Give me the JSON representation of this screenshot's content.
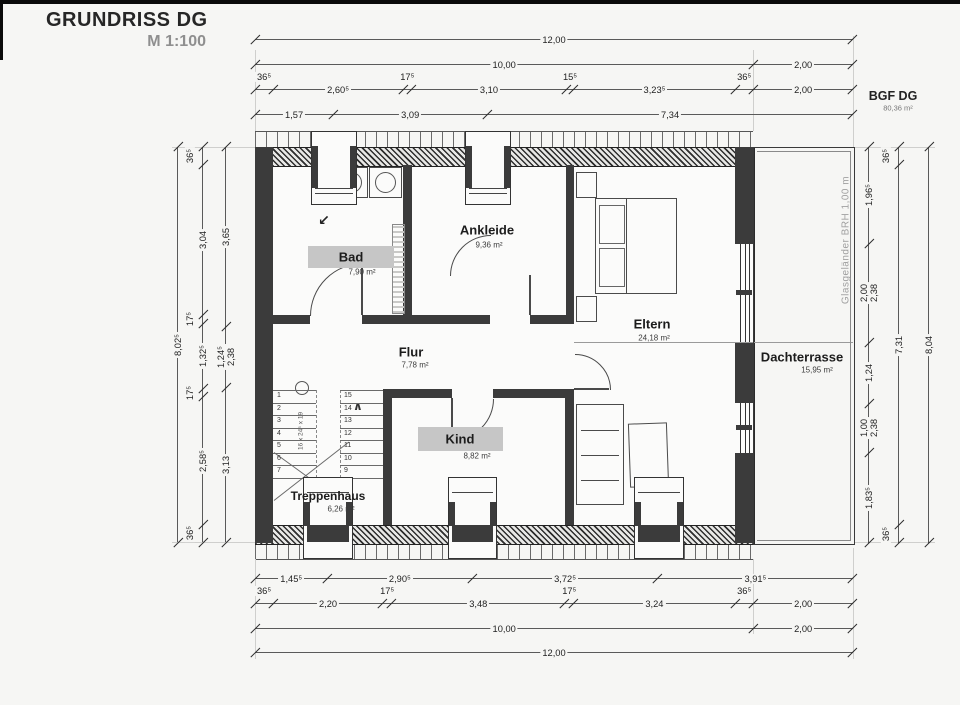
{
  "title": {
    "name": "GRUNDRISS DG",
    "scale": "M 1:100"
  },
  "summary": {
    "label": "BGF DG",
    "area": "80,36 m²"
  },
  "rooms": {
    "bad": {
      "name": "Bad",
      "area": "7,90 m²"
    },
    "ankleide": {
      "name": "Ankleide",
      "area": "9,36 m²"
    },
    "eltern": {
      "name": "Eltern",
      "area": "24,18 m²"
    },
    "flur": {
      "name": "Flur",
      "area": "7,78 m²"
    },
    "kind": {
      "name": "Kind",
      "area": "8,82 m²"
    },
    "treppenhaus": {
      "name": "Treppenhaus",
      "area": "6,26 m²"
    },
    "dachterrasse": {
      "name": "Dachterrasse",
      "area": "15,95 m²"
    }
  },
  "annotations": {
    "railing": "Glasgeländer BRH 1,00 m",
    "stair_note": "16 x 24⁵ x 19"
  },
  "icons": {
    "slope_arrow": "↙",
    "stair_direction": "∧"
  },
  "colors": {
    "highlight": "#c6c6c6",
    "wall": "#3b3b3b",
    "background": "#f6f6f4"
  },
  "stairs": {
    "left_numbers": [
      "1",
      "2",
      "3",
      "4",
      "5",
      "6",
      "7"
    ],
    "right_numbers": [
      "15",
      "14",
      "13",
      "12",
      "11",
      "10",
      "9"
    ]
  },
  "dimensions": {
    "chains": [
      {
        "o": "h",
        "x": 255,
        "y": 39,
        "ppm": 49.833,
        "segs": [
          {
            "len": 12,
            "label": "12,00"
          }
        ]
      },
      {
        "o": "h",
        "x": 255,
        "y": 64,
        "ppm": 49.833,
        "segs": [
          {
            "len": 10,
            "label": "10,00"
          },
          {
            "len": 2,
            "label": "2,00"
          }
        ]
      },
      {
        "o": "h",
        "x": 255,
        "y": 89,
        "ppm": 49.833,
        "segs": [
          {
            "len": 0.365,
            "label": "36⁵"
          },
          {
            "len": 2.605,
            "label": "2,60⁵"
          },
          {
            "len": 0.175,
            "label": "17⁵"
          },
          {
            "len": 3.1,
            "label": "3,10"
          },
          {
            "len": 0.155,
            "label": "15⁵"
          },
          {
            "len": 3.235,
            "label": "3,23⁵"
          },
          {
            "len": 0.365,
            "label": "36⁵"
          },
          {
            "len": 2,
            "label": "2,00"
          }
        ]
      },
      {
        "o": "h",
        "x": 255,
        "y": 114,
        "ppm": 49.833,
        "segs": [
          {
            "len": 1.57,
            "label": "1,57"
          },
          {
            "len": 3.09,
            "label": "3,09"
          },
          {
            "len": 7.34,
            "label": "7,34"
          }
        ]
      },
      {
        "o": "h",
        "x": 255,
        "y": 578,
        "ppm": 49.833,
        "segs": [
          {
            "len": 1.455,
            "label": "1,45⁵"
          },
          {
            "len": 2.905,
            "label": "2,90⁵"
          },
          {
            "len": 3.725,
            "label": "3,72⁵"
          },
          {
            "len": 3.915,
            "label": "3,91⁵"
          }
        ]
      },
      {
        "o": "h",
        "x": 255,
        "y": 603,
        "ppm": 49.833,
        "segs": [
          {
            "len": 0.365,
            "label": "36⁵"
          },
          {
            "len": 2.2,
            "label": "2,20"
          },
          {
            "len": 0.175,
            "label": "17⁵"
          },
          {
            "len": 3.48,
            "label": "3,48"
          },
          {
            "len": 0.175,
            "label": "17⁵"
          },
          {
            "len": 3.24,
            "label": "3,24"
          },
          {
            "len": 0.365,
            "label": "36⁵"
          },
          {
            "len": 2,
            "label": "2,00"
          }
        ]
      },
      {
        "o": "h",
        "x": 255,
        "y": 628,
        "ppm": 49.833,
        "segs": [
          {
            "len": 10,
            "label": "10,00"
          },
          {
            "len": 2,
            "label": "2,00"
          }
        ]
      },
      {
        "o": "h",
        "x": 255,
        "y": 652,
        "ppm": 49.833,
        "segs": [
          {
            "len": 12,
            "label": "12,00"
          }
        ]
      },
      {
        "o": "v",
        "x": 225,
        "y": 147,
        "ppm": 49.25,
        "segs": [
          {
            "len": 3.65,
            "label": "3,65"
          },
          {
            "len": 1.245,
            "label": "1,24⁵",
            "label2": "2,38"
          },
          {
            "len": 3.13,
            "label": "3,13"
          }
        ]
      },
      {
        "o": "v",
        "x": 202,
        "y": 147,
        "ppm": 49.25,
        "segs": [
          {
            "len": 0.365,
            "label": "36⁵"
          },
          {
            "len": 3.04,
            "label": "3,04"
          },
          {
            "len": 0.175,
            "label": "17⁵"
          },
          {
            "len": 1.325,
            "label": "1,32⁵"
          },
          {
            "len": 0.175,
            "label": "17⁵"
          },
          {
            "len": 2.585,
            "label": "2,58⁵"
          },
          {
            "len": 0.365,
            "label": "36⁵"
          }
        ]
      },
      {
        "o": "v",
        "x": 177,
        "y": 147,
        "ppm": 49.25,
        "segs": [
          {
            "len": 8.025,
            "label": "8,02⁵"
          }
        ]
      },
      {
        "o": "v",
        "x": 868,
        "y": 147,
        "ppm": 49.25,
        "segs": [
          {
            "len": 1.965,
            "label": "1,96⁵"
          },
          {
            "len": 2.0,
            "label": "2,00",
            "label2": "2,38"
          },
          {
            "len": 1.24,
            "label": "1,24"
          },
          {
            "len": 1.0,
            "label": "1,00",
            "label2": "2,38"
          },
          {
            "len": 1.835,
            "label": "1,83⁵"
          }
        ]
      },
      {
        "o": "v",
        "x": 898,
        "y": 147,
        "ppm": 49.25,
        "segs": [
          {
            "len": 0.365,
            "label": "36⁵"
          },
          {
            "len": 7.31,
            "label": "7,31"
          },
          {
            "len": 0.365,
            "label": "36⁵"
          }
        ]
      },
      {
        "o": "v",
        "x": 928,
        "y": 147,
        "ppm": 49.25,
        "segs": [
          {
            "len": 8.04,
            "label": "8,04"
          }
        ]
      }
    ]
  }
}
